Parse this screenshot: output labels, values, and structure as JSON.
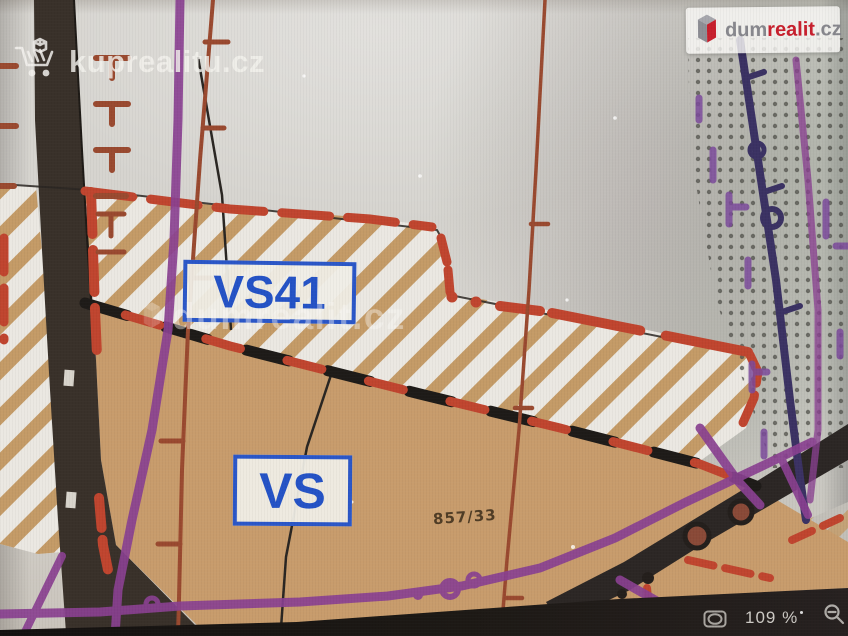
{
  "viewer": {
    "zoom_level": "109 %",
    "icons": [
      "fit-to-window-icon",
      "zoom-out-icon"
    ]
  },
  "watermarks": {
    "top_left": "kuprealitu.cz",
    "center": "dumrealit.cz"
  },
  "brand": {
    "logo_prefix": "dum",
    "logo_emphasis": "realit",
    "logo_suffix": ".cz",
    "logo_icon": "red-gray-3d-box-icon"
  },
  "map": {
    "zone_labels": [
      {
        "code": "VS41"
      },
      {
        "code": "VS"
      }
    ],
    "parcel_number": "857/33",
    "colors": {
      "zone_label_blue": "#2b57c8",
      "boundary_red": "#c0452f",
      "parcel_tan": "#c89c6c",
      "hatch_stripe": "#c49b67",
      "utility_purple": "#8a4191",
      "utility_navy": "#3b3263",
      "road_dark": "#39312a"
    }
  }
}
